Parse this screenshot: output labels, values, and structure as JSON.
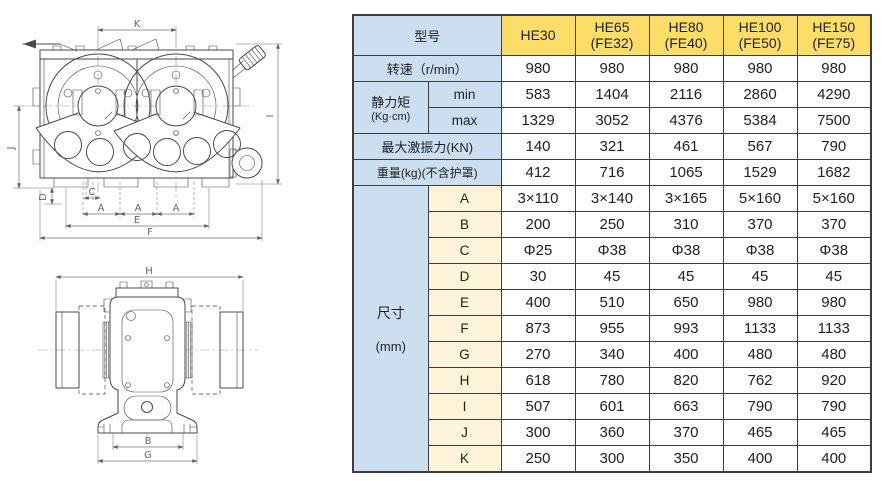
{
  "drawings": {
    "front": {
      "k": "K",
      "i": "I",
      "j": "J",
      "d": "D",
      "c": "C",
      "a": "A",
      "e": "E",
      "f": "F"
    },
    "side": {
      "h": "H",
      "b": "B",
      "g": "G"
    }
  },
  "table": {
    "colors": {
      "blue": "#cbdff0",
      "yellow": "#fcdd67",
      "cream": "#fcf3d9",
      "border": "#3d3d3d"
    },
    "header": {
      "model_label": "型号",
      "models": [
        "HE30",
        "HE65\n(FE32)",
        "HE80\n(FE40)",
        "HE100\n(FE50)",
        "HE150\n(FE75)"
      ]
    },
    "speed": {
      "label": "转速（r/min）",
      "values": [
        "980",
        "980",
        "980",
        "980",
        "980"
      ]
    },
    "moment": {
      "label": "静力矩",
      "unit": "(Kg·cm)",
      "min_label": "min",
      "max_label": "max",
      "min": [
        "583",
        "1404",
        "2116",
        "2860",
        "4290"
      ],
      "max": [
        "1329",
        "3052",
        "4376",
        "5384",
        "7500"
      ]
    },
    "force": {
      "label": "最大激振力(KN)",
      "values": [
        "140",
        "321",
        "461",
        "567",
        "790"
      ]
    },
    "weight": {
      "label": "重量(kg)(不含护罩)",
      "values": [
        "412",
        "716",
        "1065",
        "1529",
        "1682"
      ]
    },
    "dims": {
      "label": "尺寸",
      "unit": "(mm)",
      "rows": [
        {
          "key": "A",
          "values": [
            "3×110",
            "3×140",
            "3×165",
            "5×160",
            "5×160"
          ]
        },
        {
          "key": "B",
          "values": [
            "200",
            "250",
            "310",
            "370",
            "370"
          ]
        },
        {
          "key": "C",
          "values": [
            "Φ25",
            "Φ38",
            "Φ38",
            "Φ38",
            "Φ38"
          ]
        },
        {
          "key": "D",
          "values": [
            "30",
            "45",
            "45",
            "45",
            "45"
          ]
        },
        {
          "key": "E",
          "values": [
            "400",
            "510",
            "650",
            "980",
            "980"
          ]
        },
        {
          "key": "F",
          "values": [
            "873",
            "955",
            "993",
            "1133",
            "1133"
          ]
        },
        {
          "key": "G",
          "values": [
            "270",
            "340",
            "400",
            "480",
            "480"
          ]
        },
        {
          "key": "H",
          "values": [
            "618",
            "780",
            "820",
            "762",
            "920"
          ]
        },
        {
          "key": "I",
          "values": [
            "507",
            "601",
            "663",
            "790",
            "790"
          ]
        },
        {
          "key": "J",
          "values": [
            "300",
            "360",
            "370",
            "465",
            "465"
          ]
        },
        {
          "key": "K",
          "values": [
            "250",
            "300",
            "350",
            "400",
            "400"
          ]
        }
      ]
    }
  }
}
